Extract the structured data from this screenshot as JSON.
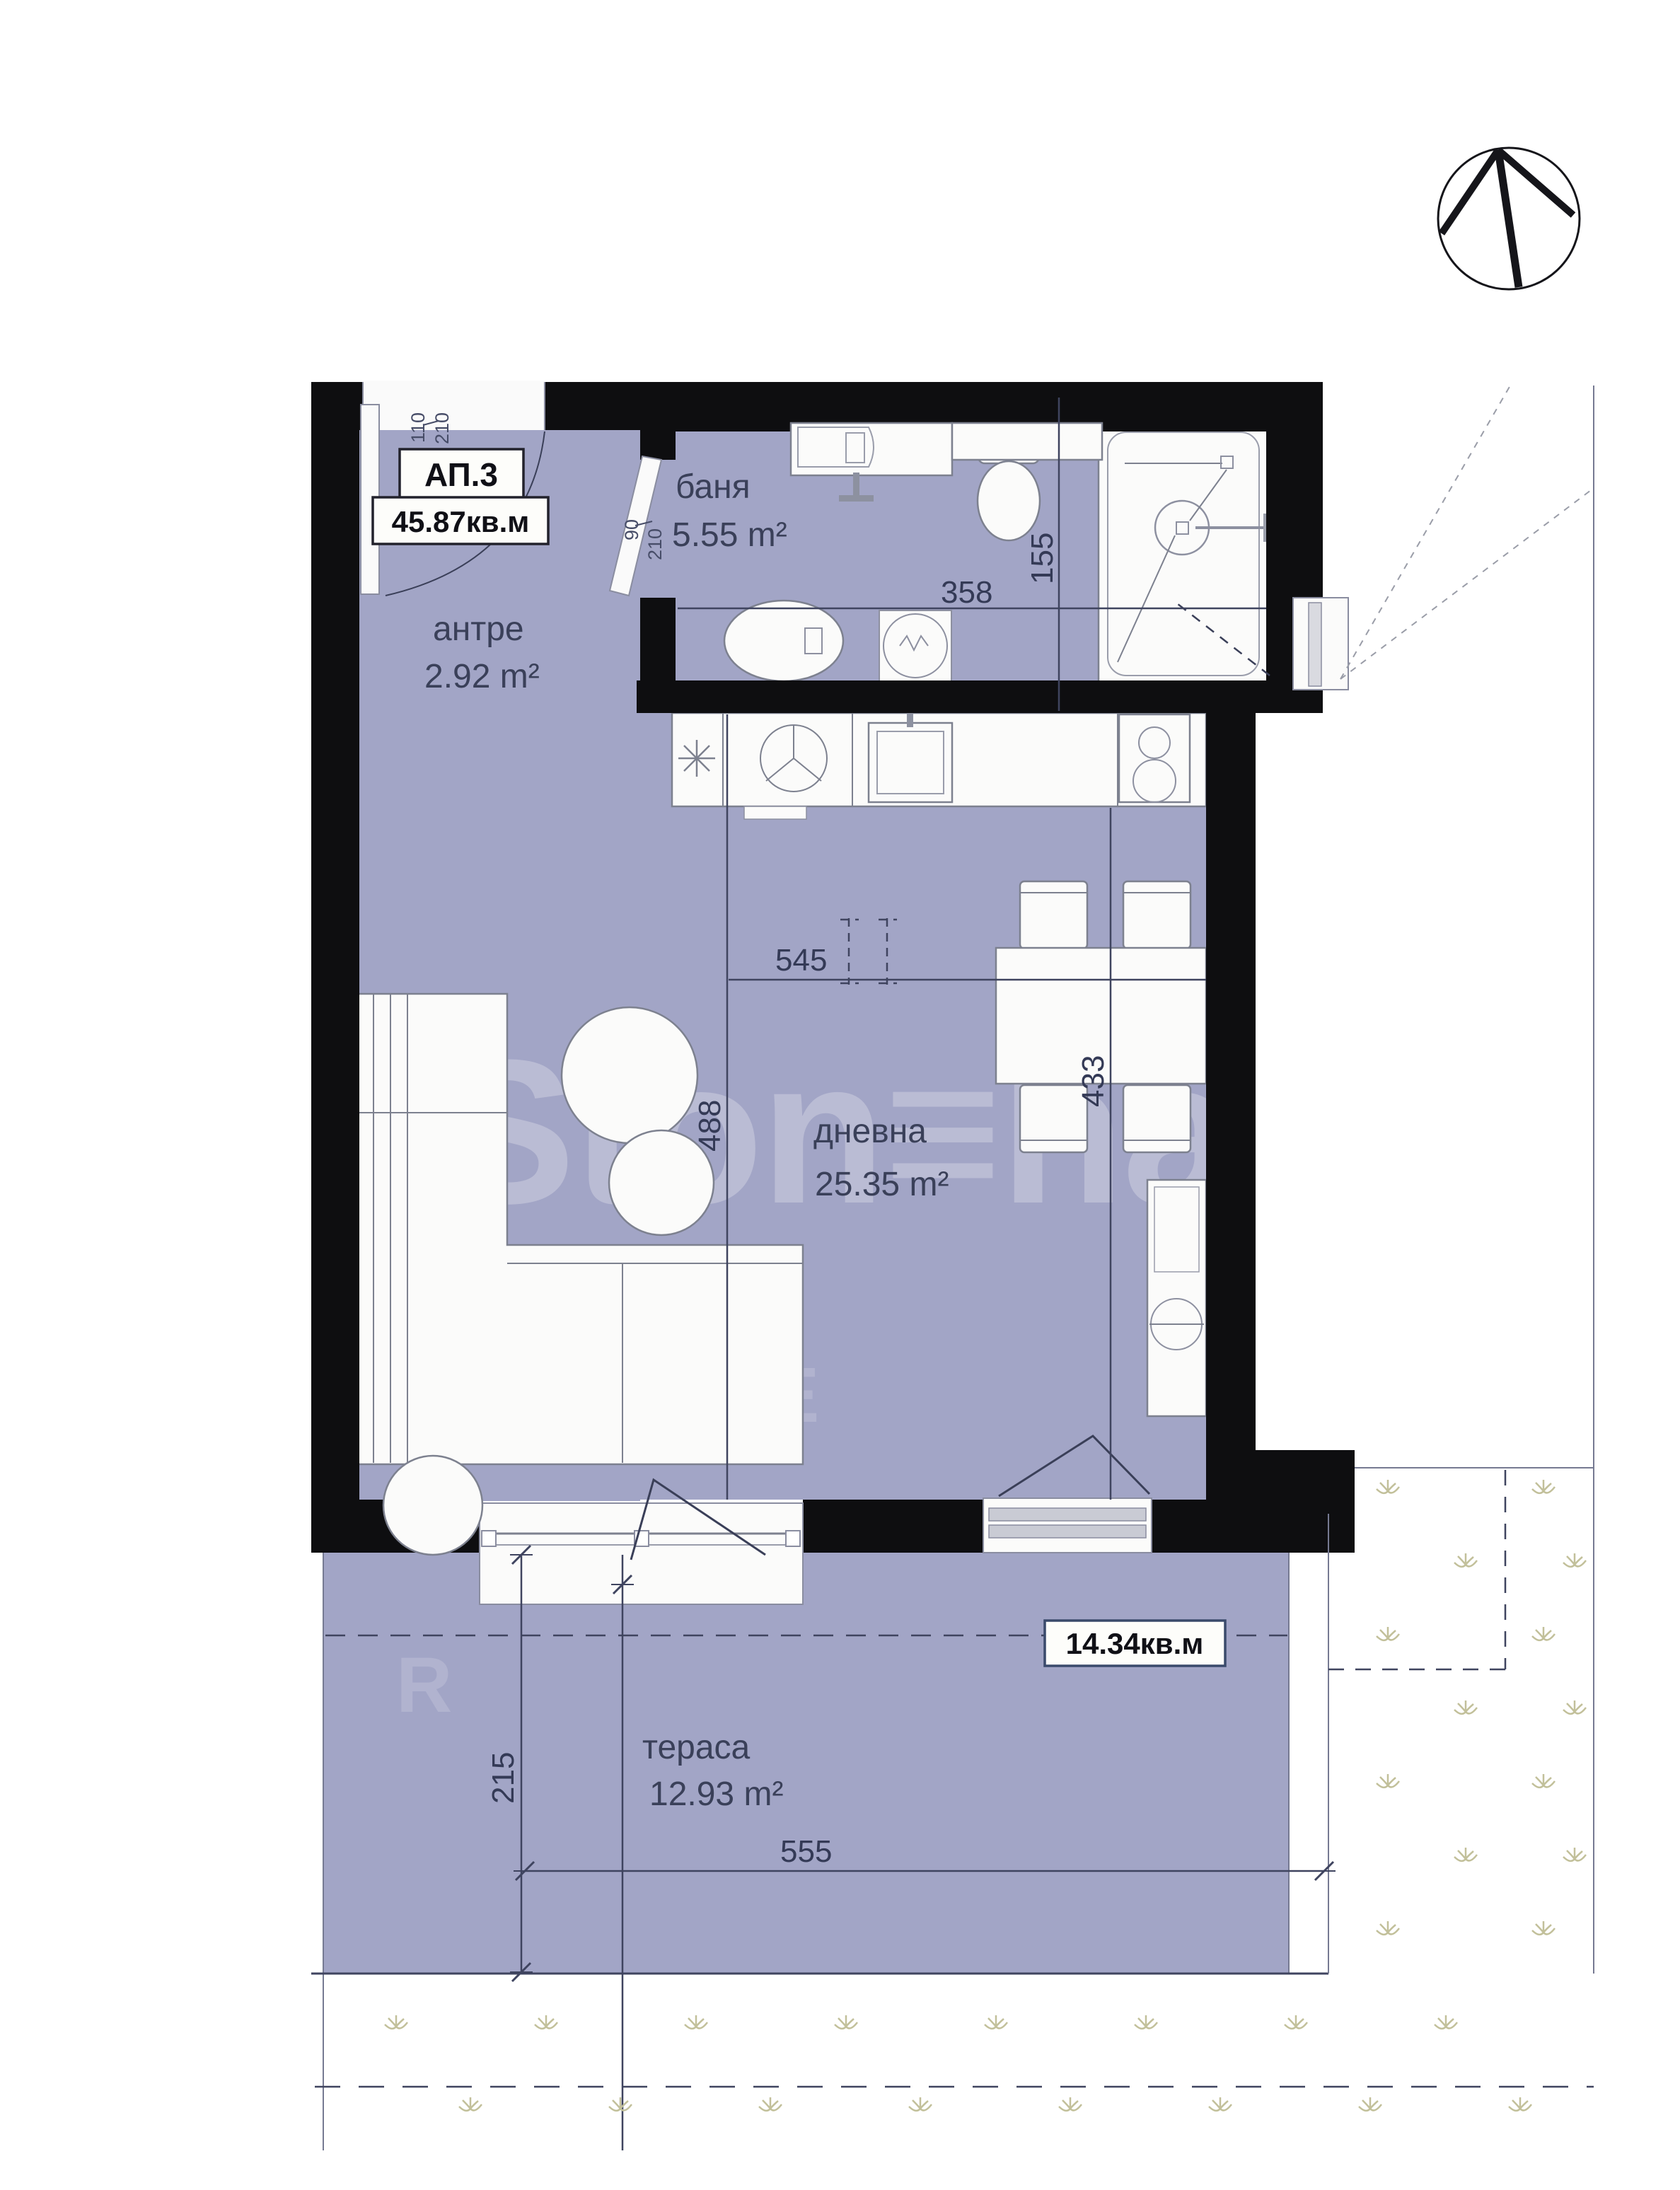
{
  "plan": {
    "apartment_label": "АП.3",
    "apartment_area": "45.87кв.м",
    "terrace_area_badge": "14.34кв.м",
    "watermark": "Ston≡hard",
    "watermark_fragment_1": "E",
    "watermark_fragment_2": "R"
  },
  "rooms": [
    {
      "name": "антре",
      "area": "2.92 m²"
    },
    {
      "name": "баня",
      "area": "5.55 m²"
    },
    {
      "name": "дневна",
      "area": "25.35 m²"
    },
    {
      "name": "тераса",
      "area": "12.93 m²"
    }
  ],
  "dimensions": {
    "bath_width": "358",
    "bath_depth": "155",
    "living_width": "545",
    "living_depth": "488",
    "dining_zone": "433",
    "terrace_depth": "215",
    "terrace_width": "555",
    "entry_door_width": "110",
    "entry_door_height": "210",
    "bath_door_width": "90",
    "bath_door_height": "210"
  },
  "icons": {
    "north_compass": "north-arrow-compass",
    "grass_mark": "grass-tuft"
  },
  "colors": {
    "floor": "#a2a5c6",
    "wall": "#0e0e10",
    "dimension": "#3f445f",
    "grass": "#c2c09a",
    "furniture_outline": "#7d818f"
  }
}
